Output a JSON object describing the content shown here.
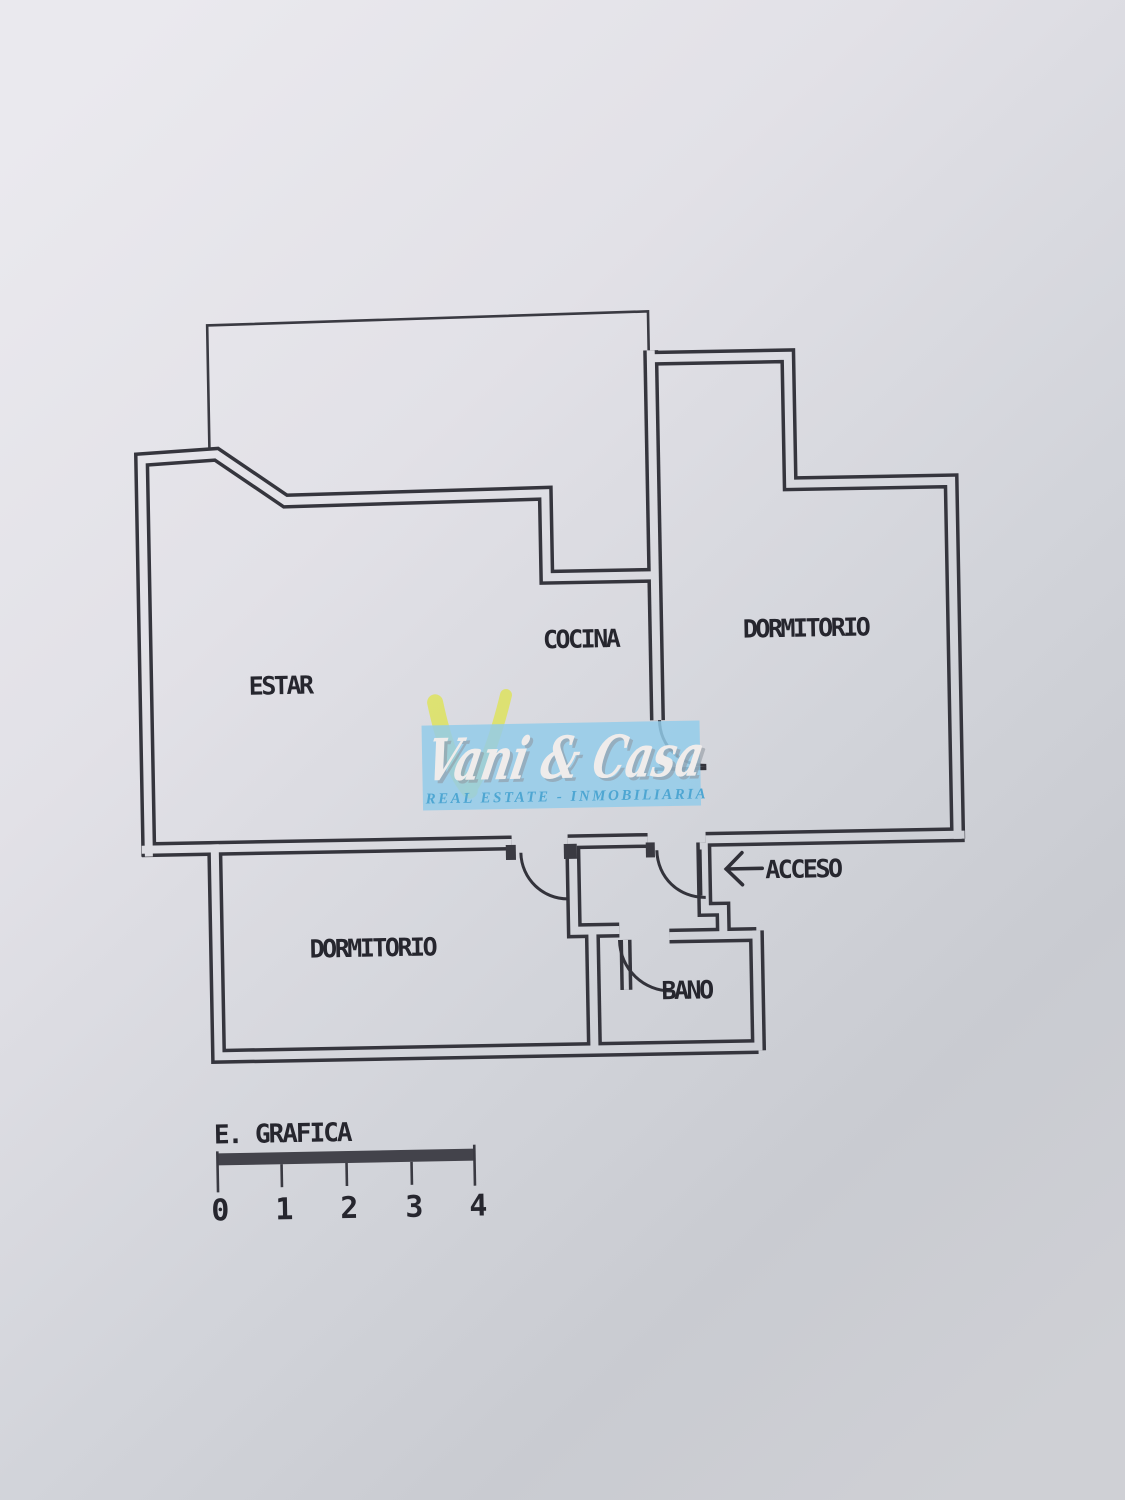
{
  "rooms": {
    "estar": "ESTAR",
    "cocina": "COCINA",
    "dormitorio_top": "DORMITORIO",
    "dormitorio_bottom": "DORMITORIO",
    "bano": "BANO"
  },
  "entrance": {
    "label": "ACCESO"
  },
  "scale_bar": {
    "label": "E. GRAFICA",
    "ticks": [
      "0",
      "1",
      "2",
      "3",
      "4"
    ]
  },
  "watermark": {
    "brand": "Vani & Casa",
    "caption": "REAL ESTATE   -   INMOBILIARIA"
  },
  "colors": {
    "paper_light": "#eae9ee",
    "paper_dark": "#c6c8ce",
    "ink": "#35353d",
    "watermark_blue": "#92cce9",
    "watermark_yellow": "#dde268",
    "watermark_text": "#efeceb",
    "caption_blue": "#4ea6d2"
  }
}
